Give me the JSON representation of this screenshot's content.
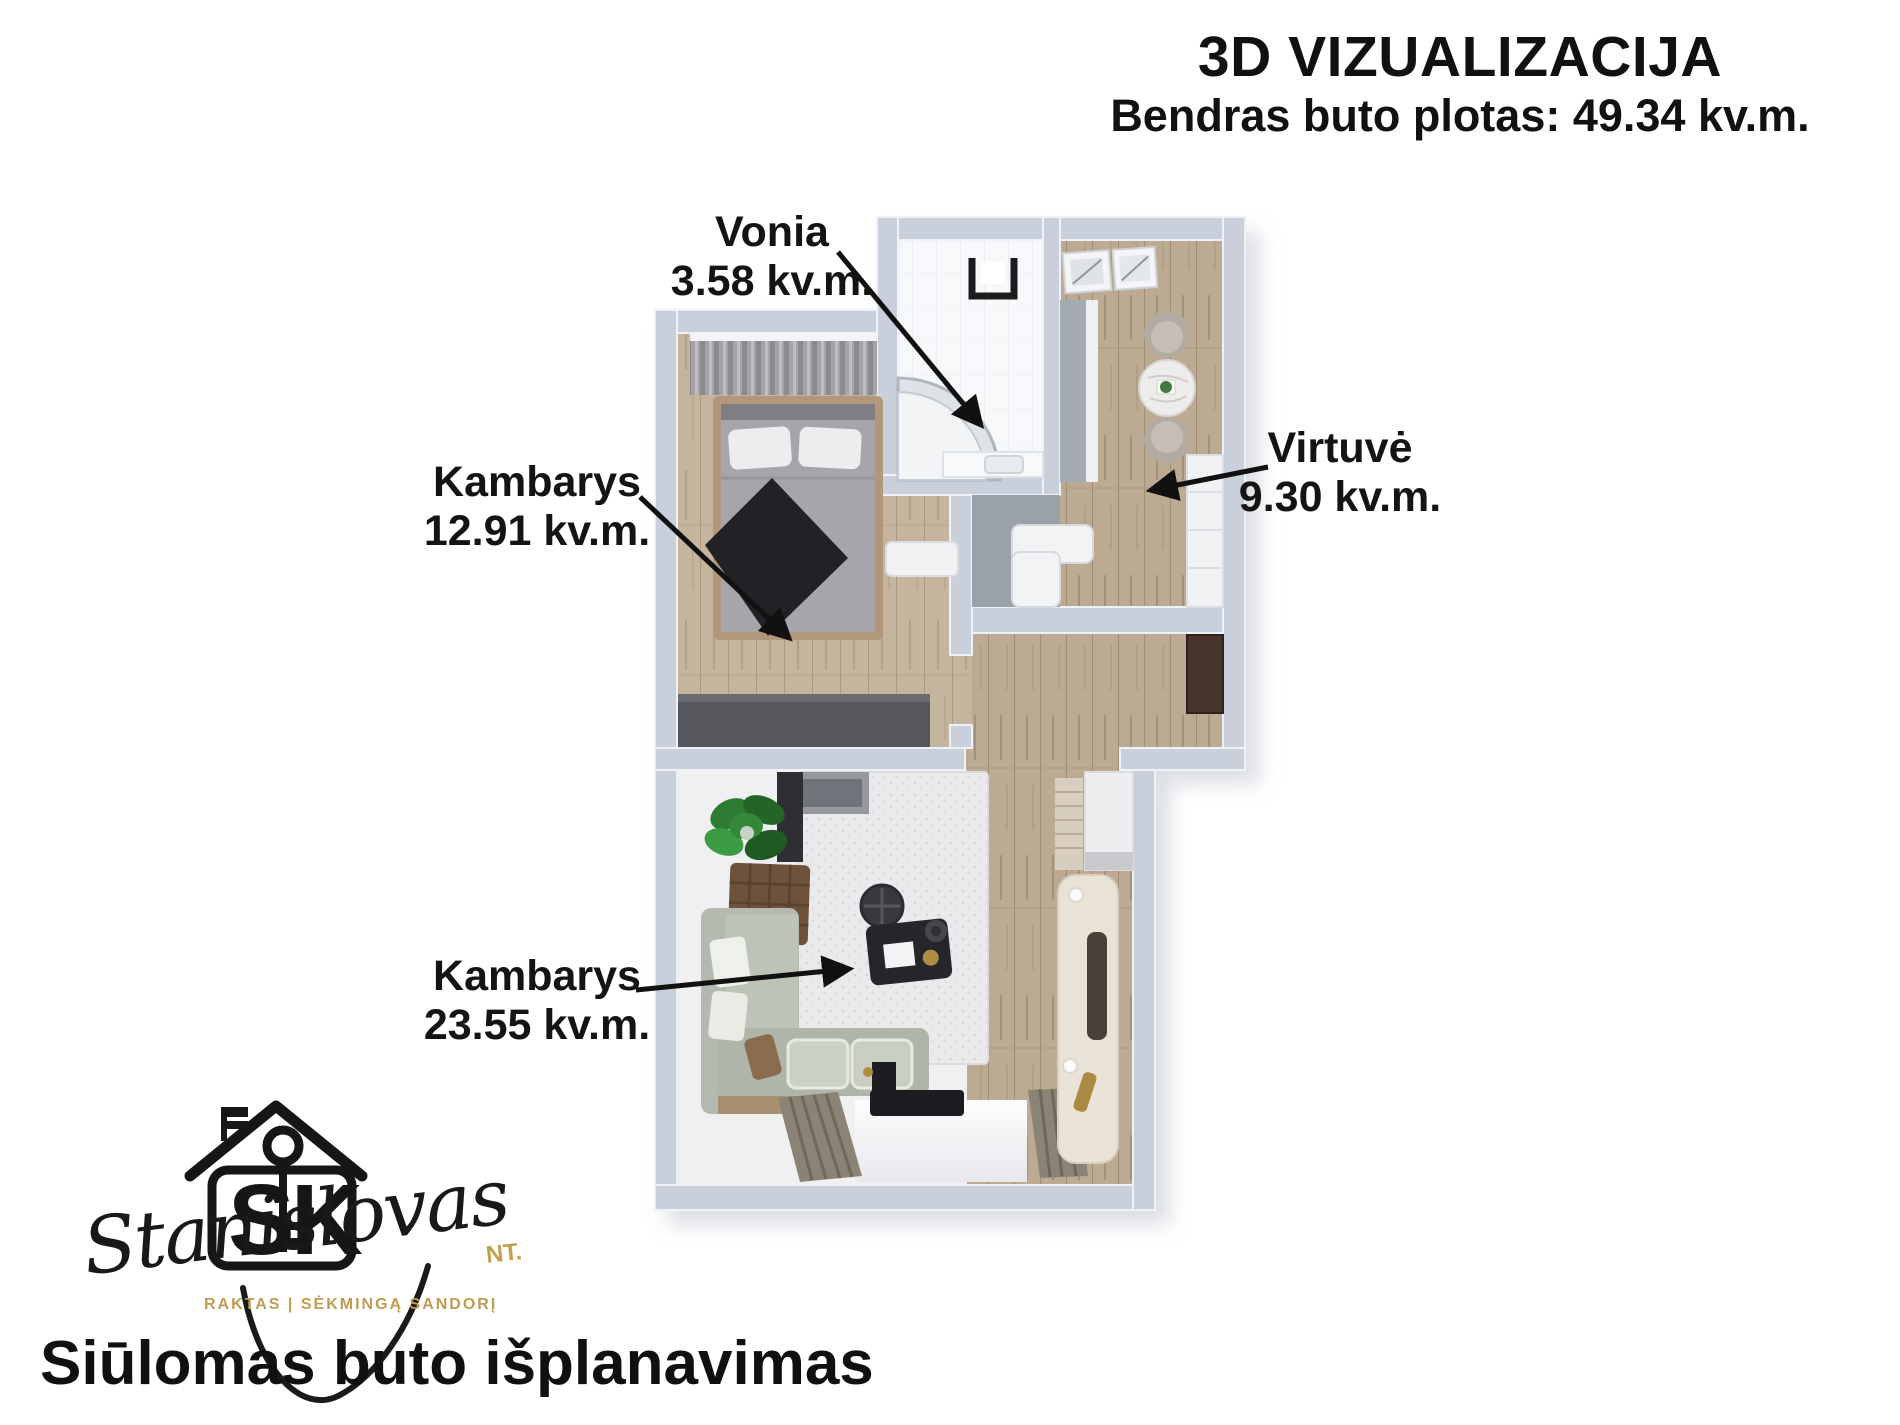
{
  "header": {
    "title": "3D VIZUALIZACIJA",
    "subtitle": "Bendras buto plotas: 49.34 kv.m."
  },
  "labels": {
    "vonia": {
      "name": "Vonia",
      "area": "3.58 kv.m."
    },
    "kambarys1": {
      "name": "Kambarys",
      "area": "12.91 kv.m."
    },
    "virtuve": {
      "name": "Virtuvė",
      "area": "9.30 kv.m."
    },
    "kambarys2": {
      "name": "Kambarys",
      "area": "23.55 kv.m."
    }
  },
  "logo": {
    "monogram": "SK",
    "script": "Stanislovas",
    "suffix": "NT.",
    "tagline": "RAKTAS | SĖKMINGĄ SANDORĮ"
  },
  "footer": {
    "heading": "Siūlomas buto išplanavimas"
  },
  "colors": {
    "brand_gold": "#bf9c52",
    "wall": "#c9cfdb",
    "wood_light": "#c6b59e",
    "wood_dark": "#bcab92",
    "label_text": "#141414"
  }
}
